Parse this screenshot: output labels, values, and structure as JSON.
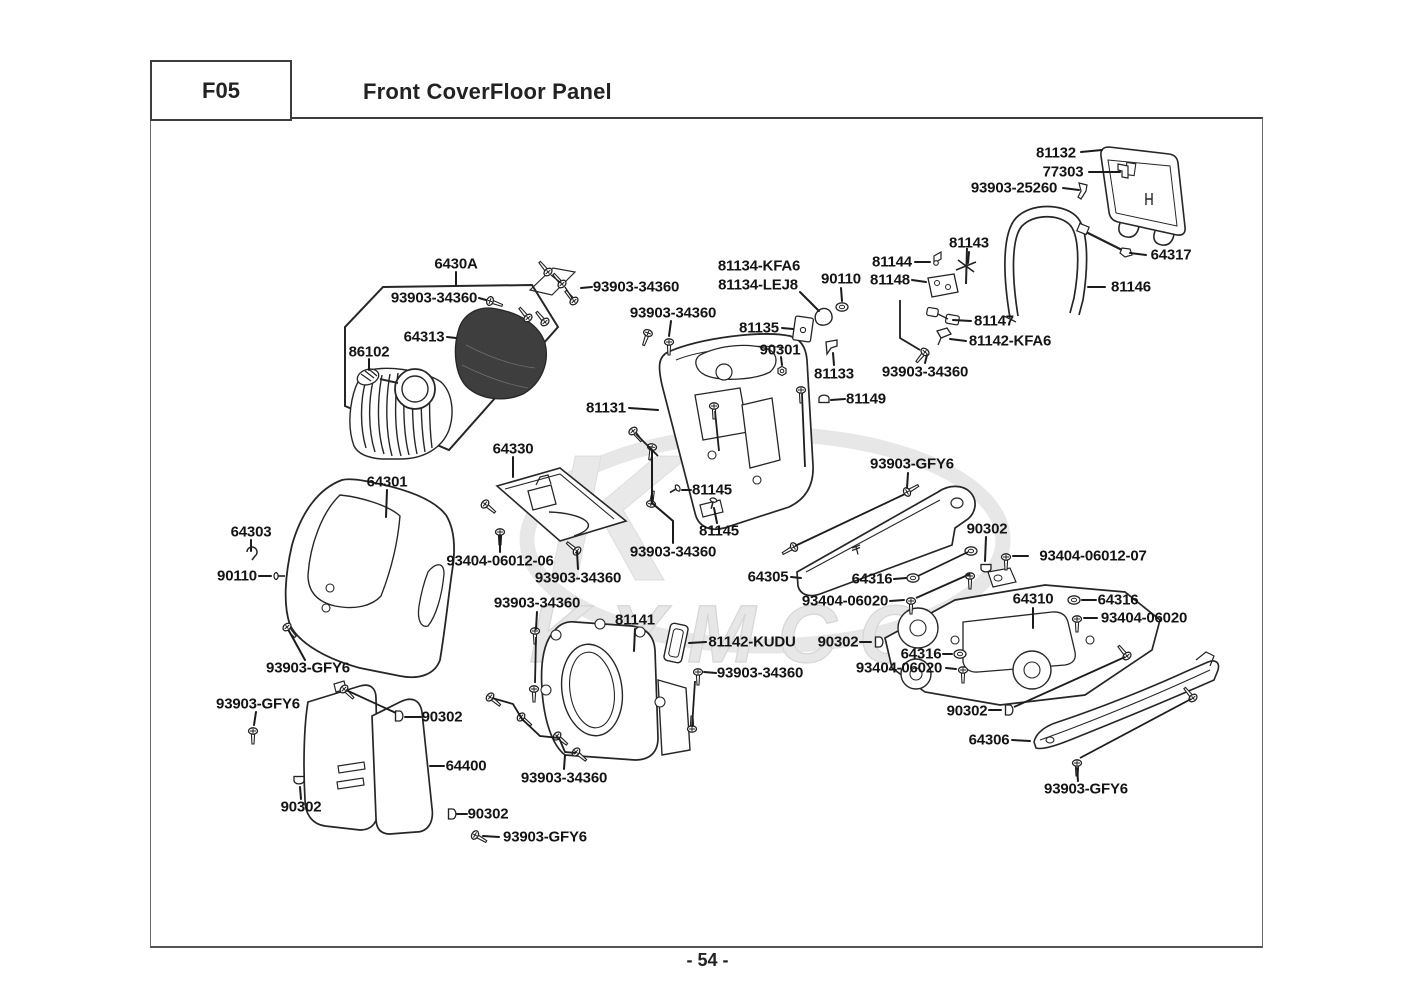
{
  "header": {
    "code": "F05",
    "title": "Front CoverFloor Panel"
  },
  "footer": {
    "page": "- 54 -"
  },
  "watermark": {
    "monogram": "K",
    "brand": "KYMCO"
  },
  "diagram": {
    "labels": [
      {
        "text": "81132",
        "x": 1056,
        "y": 153,
        "line": [
          [
            1081,
            152
          ],
          [
            1102,
            150
          ]
        ]
      },
      {
        "text": "77303",
        "x": 1063,
        "y": 172,
        "line": [
          [
            1089,
            172
          ],
          [
            1120,
            172
          ]
        ]
      },
      {
        "text": "93903-25260",
        "x": 1014,
        "y": 188,
        "line": [
          [
            1063,
            188
          ],
          [
            1079,
            190
          ]
        ]
      },
      {
        "text": "81143",
        "x": 969,
        "y": 243,
        "line": [
          [
            969,
            252
          ],
          [
            968,
            263
          ]
        ]
      },
      {
        "text": "64317",
        "x": 1171,
        "y": 255,
        "line": [
          [
            1146,
            255
          ],
          [
            1130,
            253
          ]
        ]
      },
      {
        "text": "81146",
        "x": 1131,
        "y": 287,
        "line": [
          [
            1105,
            287
          ],
          [
            1088,
            287
          ]
        ]
      },
      {
        "text": "81144",
        "x": 892,
        "y": 262,
        "line": [
          [
            915,
            262
          ],
          [
            930,
            262
          ]
        ]
      },
      {
        "text": "90110",
        "x": 841,
        "y": 279,
        "line": [
          [
            841,
            288
          ],
          [
            842,
            301
          ]
        ]
      },
      {
        "text": "81148",
        "x": 890,
        "y": 280,
        "line": [
          [
            912,
            280
          ],
          [
            926,
            282
          ]
        ]
      },
      {
        "text": "81147",
        "x": 994,
        "y": 321,
        "line": [
          [
            971,
            321
          ],
          [
            953,
            320
          ]
        ]
      },
      {
        "text": "81142-KFA6",
        "x": 1010,
        "y": 341,
        "line": [
          [
            966,
            341
          ],
          [
            950,
            339
          ]
        ]
      },
      {
        "text": "93903-34360",
        "x": 925,
        "y": 372,
        "line": [
          [
            925,
            363
          ],
          [
            927,
            355
          ]
        ]
      },
      {
        "text": "81133",
        "x": 834,
        "y": 374,
        "line": [
          [
            834,
            365
          ],
          [
            833,
            353
          ]
        ]
      },
      {
        "text": "81149",
        "x": 866,
        "y": 399,
        "line": [
          [
            845,
            399
          ],
          [
            831,
            400
          ]
        ]
      },
      {
        "text": "81134-KFA6",
        "x": 759,
        "y": 266
      },
      {
        "text": "81134-LEJ8",
        "x": 758,
        "y": 285,
        "line": [
          [
            800,
            292
          ],
          [
            819,
            311
          ]
        ]
      },
      {
        "text": "93903-34360",
        "x": 636,
        "y": 287,
        "line": [
          [
            592,
            287
          ],
          [
            581,
            288
          ]
        ]
      },
      {
        "text": "93903-34360",
        "x": 673,
        "y": 313,
        "line": [
          [
            671,
            321
          ],
          [
            669,
            336
          ]
        ]
      },
      {
        "text": "81135",
        "x": 759,
        "y": 328,
        "line": [
          [
            782,
            328
          ],
          [
            793,
            329
          ]
        ]
      },
      {
        "text": "90301",
        "x": 780,
        "y": 350,
        "line": [
          [
            781,
            357
          ],
          [
            782,
            365
          ]
        ]
      },
      {
        "text": "81131",
        "x": 606,
        "y": 408,
        "line": [
          [
            629,
            408
          ],
          [
            658,
            410
          ]
        ]
      },
      {
        "text": "6430A",
        "x": 456,
        "y": 264,
        "line": [
          [
            456,
            272
          ],
          [
            456,
            285
          ]
        ]
      },
      {
        "text": "93903-34360",
        "x": 434,
        "y": 298,
        "line": [
          [
            479,
            298
          ],
          [
            486,
            300
          ]
        ]
      },
      {
        "text": "64313",
        "x": 424,
        "y": 337,
        "line": [
          [
            447,
            337
          ],
          [
            456,
            338
          ]
        ]
      },
      {
        "text": "86102",
        "x": 369,
        "y": 352,
        "line": [
          [
            369,
            359
          ],
          [
            369,
            370
          ]
        ]
      },
      {
        "text": "64330",
        "x": 513,
        "y": 449,
        "line": [
          [
            513,
            457
          ],
          [
            513,
            477
          ]
        ]
      },
      {
        "text": "81145",
        "x": 712,
        "y": 490,
        "line": [
          [
            691,
            490
          ],
          [
            682,
            490
          ]
        ]
      },
      {
        "text": "81145",
        "x": 719,
        "y": 531,
        "line": [
          [
            717,
            523
          ],
          [
            714,
            508
          ]
        ]
      },
      {
        "text": "93903-34360",
        "x": 673,
        "y": 552,
        "line": [
          [
            673,
            543
          ],
          [
            673,
            521
          ],
          [
            652,
            503
          ],
          [
            652,
            450
          ]
        ]
      },
      {
        "text": "93404-06012-06",
        "x": 500,
        "y": 561,
        "line": [
          [
            500,
            552
          ],
          [
            500,
            535
          ]
        ]
      },
      {
        "text": "93903-34360",
        "x": 578,
        "y": 578,
        "line": [
          [
            578,
            569
          ],
          [
            577,
            552
          ]
        ]
      },
      {
        "text": "93903-34360",
        "x": 537,
        "y": 603,
        "line": [
          [
            537,
            612
          ],
          [
            536,
            629
          ]
        ]
      },
      {
        "text": "81141",
        "x": 635,
        "y": 620,
        "line": [
          [
            635,
            629
          ],
          [
            634,
            651
          ]
        ]
      },
      {
        "text": "81142-KUDU",
        "x": 752,
        "y": 642,
        "line": [
          [
            706,
            642
          ],
          [
            689,
            643
          ]
        ]
      },
      {
        "text": "93903-34360",
        "x": 760,
        "y": 673,
        "line": [
          [
            716,
            673
          ],
          [
            704,
            672
          ]
        ]
      },
      {
        "text": "93903-GFY6",
        "x": 912,
        "y": 464,
        "line": [
          [
            908,
            473
          ],
          [
            907,
            488
          ]
        ]
      },
      {
        "text": "64305",
        "x": 768,
        "y": 577,
        "line": [
          [
            791,
            577
          ],
          [
            801,
            578
          ]
        ]
      },
      {
        "text": "64316",
        "x": 872,
        "y": 579,
        "line": [
          [
            894,
            579
          ],
          [
            906,
            578
          ]
        ]
      },
      {
        "text": "93404-06020",
        "x": 845,
        "y": 601,
        "line": [
          [
            890,
            601
          ],
          [
            904,
            600
          ]
        ]
      },
      {
        "text": "90302",
        "x": 987,
        "y": 529,
        "line": [
          [
            986,
            537
          ],
          [
            985,
            561
          ]
        ]
      },
      {
        "text": "93404-06012-07",
        "x": 1093,
        "y": 556,
        "line": [
          [
            1028,
            556
          ],
          [
            1013,
            556
          ]
        ]
      },
      {
        "text": "64310",
        "x": 1033,
        "y": 599,
        "line": [
          [
            1033,
            608
          ],
          [
            1033,
            628
          ]
        ]
      },
      {
        "text": "64316",
        "x": 1118,
        "y": 600,
        "line": [
          [
            1096,
            600
          ],
          [
            1082,
            600
          ]
        ]
      },
      {
        "text": "93404-06020",
        "x": 1144,
        "y": 618,
        "line": [
          [
            1097,
            618
          ],
          [
            1084,
            618
          ]
        ]
      },
      {
        "text": "90302",
        "x": 838,
        "y": 642,
        "line": [
          [
            860,
            642
          ],
          [
            871,
            642
          ]
        ]
      },
      {
        "text": "64316",
        "x": 921,
        "y": 654,
        "line": [
          [
            943,
            654
          ],
          [
            952,
            654
          ]
        ]
      },
      {
        "text": "93404-06020",
        "x": 899,
        "y": 668,
        "line": [
          [
            946,
            668
          ],
          [
            956,
            669
          ]
        ]
      },
      {
        "text": "90302",
        "x": 967,
        "y": 711,
        "line": [
          [
            989,
            710
          ],
          [
            1001,
            710
          ]
        ]
      },
      {
        "text": "64306",
        "x": 989,
        "y": 740,
        "line": [
          [
            1012,
            740
          ],
          [
            1030,
            741
          ]
        ]
      },
      {
        "text": "93903-GFY6",
        "x": 1086,
        "y": 789,
        "line": [
          [
            1078,
            781
          ],
          [
            1077,
            768
          ]
        ]
      },
      {
        "text": "64301",
        "x": 387,
        "y": 482,
        "line": [
          [
            387,
            490
          ],
          [
            386,
            517
          ]
        ]
      },
      {
        "text": "64303",
        "x": 251,
        "y": 532,
        "line": [
          [
            251,
            540
          ],
          [
            251,
            551
          ]
        ]
      },
      {
        "text": "90110",
        "x": 237,
        "y": 576,
        "line": [
          [
            259,
            576
          ],
          [
            271,
            576
          ]
        ]
      },
      {
        "text": "93903-GFY6",
        "x": 308,
        "y": 668,
        "line": [
          [
            305,
            660
          ],
          [
            289,
            631
          ]
        ]
      },
      {
        "text": "93903-GFY6",
        "x": 258,
        "y": 704,
        "line": [
          [
            256,
            712
          ],
          [
            254,
            725
          ]
        ]
      },
      {
        "text": "90302",
        "x": 442,
        "y": 717,
        "line": [
          [
            421,
            717
          ],
          [
            405,
            717
          ]
        ]
      },
      {
        "text": "64400",
        "x": 466,
        "y": 766,
        "line": [
          [
            444,
            766
          ],
          [
            430,
            766
          ]
        ]
      },
      {
        "text": "90302",
        "x": 301,
        "y": 807,
        "line": [
          [
            301,
            799
          ],
          [
            300,
            787
          ]
        ]
      },
      {
        "text": "90302",
        "x": 488,
        "y": 814,
        "line": [
          [
            467,
            814
          ],
          [
            457,
            814
          ]
        ]
      },
      {
        "text": "93903-GFY6",
        "x": 545,
        "y": 837,
        "line": [
          [
            499,
            837
          ],
          [
            483,
            836
          ]
        ]
      },
      {
        "text": "93903-34360",
        "x": 564,
        "y": 778,
        "line": [
          [
            564,
            769
          ],
          [
            565,
            755
          ]
        ]
      }
    ]
  }
}
